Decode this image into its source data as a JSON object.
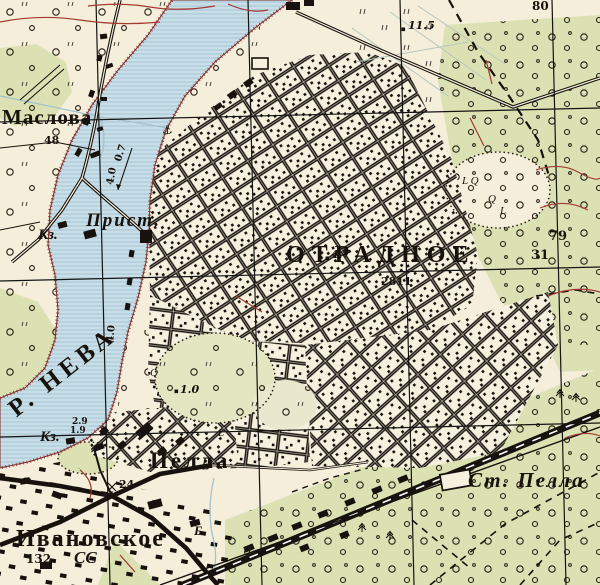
{
  "map": {
    "colors": {
      "paper": "#f4eeda",
      "vegetation_green": "#dce1b4",
      "water_blue": "#cadee8",
      "water_stripe": "#9fc2d2",
      "ink_black": "#1b1510",
      "contour_red": "#a23a32",
      "bank_red": "#7c2a24",
      "stream_blue": "#a5c2cc"
    },
    "labels": [
      {
        "name": "label-maslova",
        "text": "Маслова",
        "x": 2,
        "y": 107,
        "size": 21,
        "ls": 1,
        "cls": "town"
      },
      {
        "name": "label-maslova-count",
        "text": "48",
        "x": 44,
        "y": 135,
        "size": 11,
        "cls": "num"
      },
      {
        "name": "label-pier",
        "text": "Прист.",
        "x": 86,
        "y": 211,
        "size": 19,
        "ls": 2,
        "cls": "ital town"
      },
      {
        "name": "label-kz-1",
        "text": "Кз.",
        "x": 38,
        "y": 228,
        "size": 15,
        "cls": "ital town"
      },
      {
        "name": "label-kz-2",
        "text": "Кз.",
        "x": 40,
        "y": 430,
        "size": 15,
        "cls": "ital town"
      },
      {
        "name": "label-river-neva",
        "text": "Р. НЕВА",
        "x": 4,
        "y": 402,
        "size": 25,
        "rot": -38,
        "ls": 5,
        "cls": "river"
      },
      {
        "name": "label-depth-2-9",
        "text": "2.9",
        "x": 72,
        "y": 418,
        "size": 9,
        "cls": "num"
      },
      {
        "name": "label-depth-1-9",
        "text": "1.9",
        "x": 70,
        "y": 427,
        "size": 9,
        "cls": "num"
      },
      {
        "name": "label-flow-speed",
        "text": "0.7",
        "x": 114,
        "y": 160,
        "size": 10,
        "rot": -72,
        "cls": "num"
      },
      {
        "name": "label-depth-4-0-a",
        "text": "4.0",
        "x": 106,
        "y": 184,
        "size": 10,
        "rot": -80,
        "cls": "num"
      },
      {
        "name": "label-depth-4-0-b",
        "text": "4.0",
        "x": 106,
        "y": 342,
        "size": 10,
        "rot": -84,
        "cls": "num"
      },
      {
        "name": "label-otradnoye",
        "text": "ОТРАДНОЕ",
        "x": 286,
        "y": 243,
        "size": 24,
        "ls": 7,
        "cls": "city"
      },
      {
        "name": "label-otradnoye-count",
        "text": "2811",
        "x": 381,
        "y": 276,
        "size": 11,
        "cls": "num"
      },
      {
        "name": "label-height-11-5",
        "text": "11.5",
        "x": 408,
        "y": 20,
        "size": 11,
        "cls": "num ital"
      },
      {
        "name": "label-height-4-7",
        "text": "4.7",
        "x": 331,
        "y": 249,
        "size": 11,
        "cls": "num ital"
      },
      {
        "name": "label-height-1-0",
        "text": "1.0",
        "x": 180,
        "y": 384,
        "size": 11,
        "cls": "num ital"
      },
      {
        "name": "label-grid-80",
        "text": "80",
        "x": 532,
        "y": 0,
        "size": 12,
        "cls": "num"
      },
      {
        "name": "label-grid-79",
        "text": "79",
        "x": 549,
        "y": 230,
        "size": 13,
        "cls": "num"
      },
      {
        "name": "label-grid-31",
        "text": "31",
        "x": 531,
        "y": 249,
        "size": 13,
        "cls": "num"
      },
      {
        "name": "label-pella",
        "text": "Пелла",
        "x": 150,
        "y": 449,
        "size": 23,
        "ls": 3,
        "cls": "town"
      },
      {
        "name": "label-pella-count",
        "text": "24",
        "x": 119,
        "y": 479,
        "size": 11,
        "cls": "num"
      },
      {
        "name": "label-ivanovskoye",
        "text": "Ивановское",
        "x": 16,
        "y": 527,
        "size": 24,
        "ls": 2,
        "cls": "town"
      },
      {
        "name": "label-ivanovskoye-count",
        "text": "132",
        "x": 26,
        "y": 553,
        "size": 12,
        "cls": "num"
      },
      {
        "name": "label-ivanovskoye-ss",
        "text": "СС",
        "x": 74,
        "y": 549,
        "size": 17,
        "cls": "ital town"
      },
      {
        "name": "label-st-pella",
        "text": "Ст. Пелла",
        "x": 468,
        "y": 470,
        "size": 21,
        "ls": 2,
        "cls": "town ital"
      },
      {
        "name": "label-stream-b",
        "text": "Б.",
        "x": 194,
        "y": 524,
        "size": 13,
        "cls": "ital town"
      },
      {
        "name": "label-veg-lq",
        "text": "L Q",
        "x": 462,
        "y": 176,
        "size": 11,
        "cls": "ital"
      },
      {
        "name": "label-veg-q1",
        "text": "Q",
        "x": 488,
        "y": 194,
        "size": 11,
        "cls": "ital"
      },
      {
        "name": "label-veg-l1",
        "text": "L",
        "x": 500,
        "y": 206,
        "size": 11,
        "cls": "ital"
      },
      {
        "name": "label-veg-q2",
        "text": "Q",
        "x": 150,
        "y": 368,
        "size": 11,
        "cls": "ital"
      },
      {
        "name": "label-veg-l2",
        "text": "L",
        "x": 218,
        "y": 428,
        "size": 11,
        "cls": "ital"
      },
      {
        "name": "anchor-symbol",
        "text": "⚓",
        "x": 162,
        "y": 124,
        "size": 12,
        "cls": "sym"
      }
    ]
  }
}
